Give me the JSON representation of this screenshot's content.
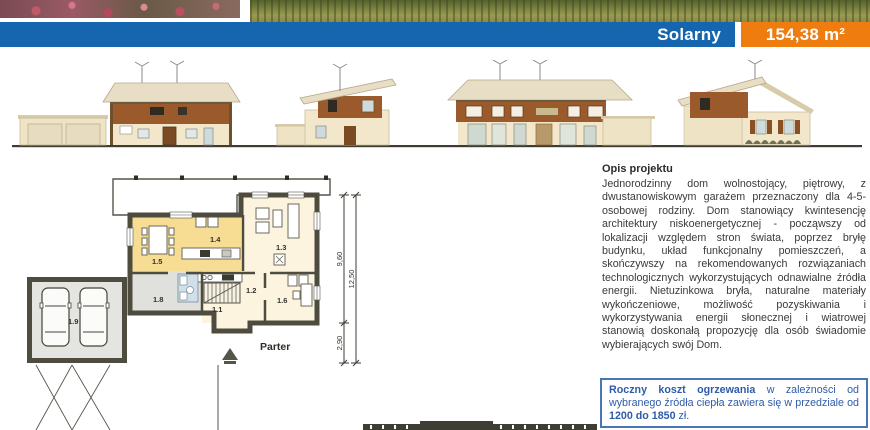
{
  "header": {
    "title": "Solarny",
    "area": "154,38 m²"
  },
  "plan": {
    "floor_label": "Parter",
    "rooms": {
      "r11": "1.1",
      "r12": "1.2",
      "r13": "1.3",
      "r14": "1.4",
      "r15": "1.5",
      "r16": "1.6",
      "r18": "1.8",
      "r19": "1.9"
    },
    "dims": {
      "top": "9,60",
      "bottom": "2,90",
      "total": "12,50"
    }
  },
  "description": {
    "heading": "Opis projektu",
    "body": "Jednorodzinny dom wolnostojący, piętrowy, z dwustanowiskowym garażem przeznaczony dla 4-5-osobowej rodziny. Dom stanowiący kwintesencję architektury niskoenergetycznej - począwszy od lokalizacji względem stron świata, poprzez bryłę budynku, układ funkcjonalny pomieszczeń, a skończywszy na rekomendowanych rozwiązaniach technologicznych wykorzystujących odnawialne źródła energii. Nietuzinkowa bryła, naturalne materiały wykończeniowe, możliwość pozyskiwania i wykorzystywania energii słonecznej i wiatrowej stanowią doskonałą propozycję dla osób świadomie wybierających swój Dom."
  },
  "cost_box": {
    "lead": "Roczny koszt ogrzewania",
    "middle": " w zależności od wybranego źródła ciepła zawiera się w przedziale od ",
    "value": "1200 do 1850",
    "tail": " zł."
  },
  "colors": {
    "accent_blue": "#1566ae",
    "accent_orange": "#ee7c0e",
    "info_blue": "#2d5ca8"
  }
}
